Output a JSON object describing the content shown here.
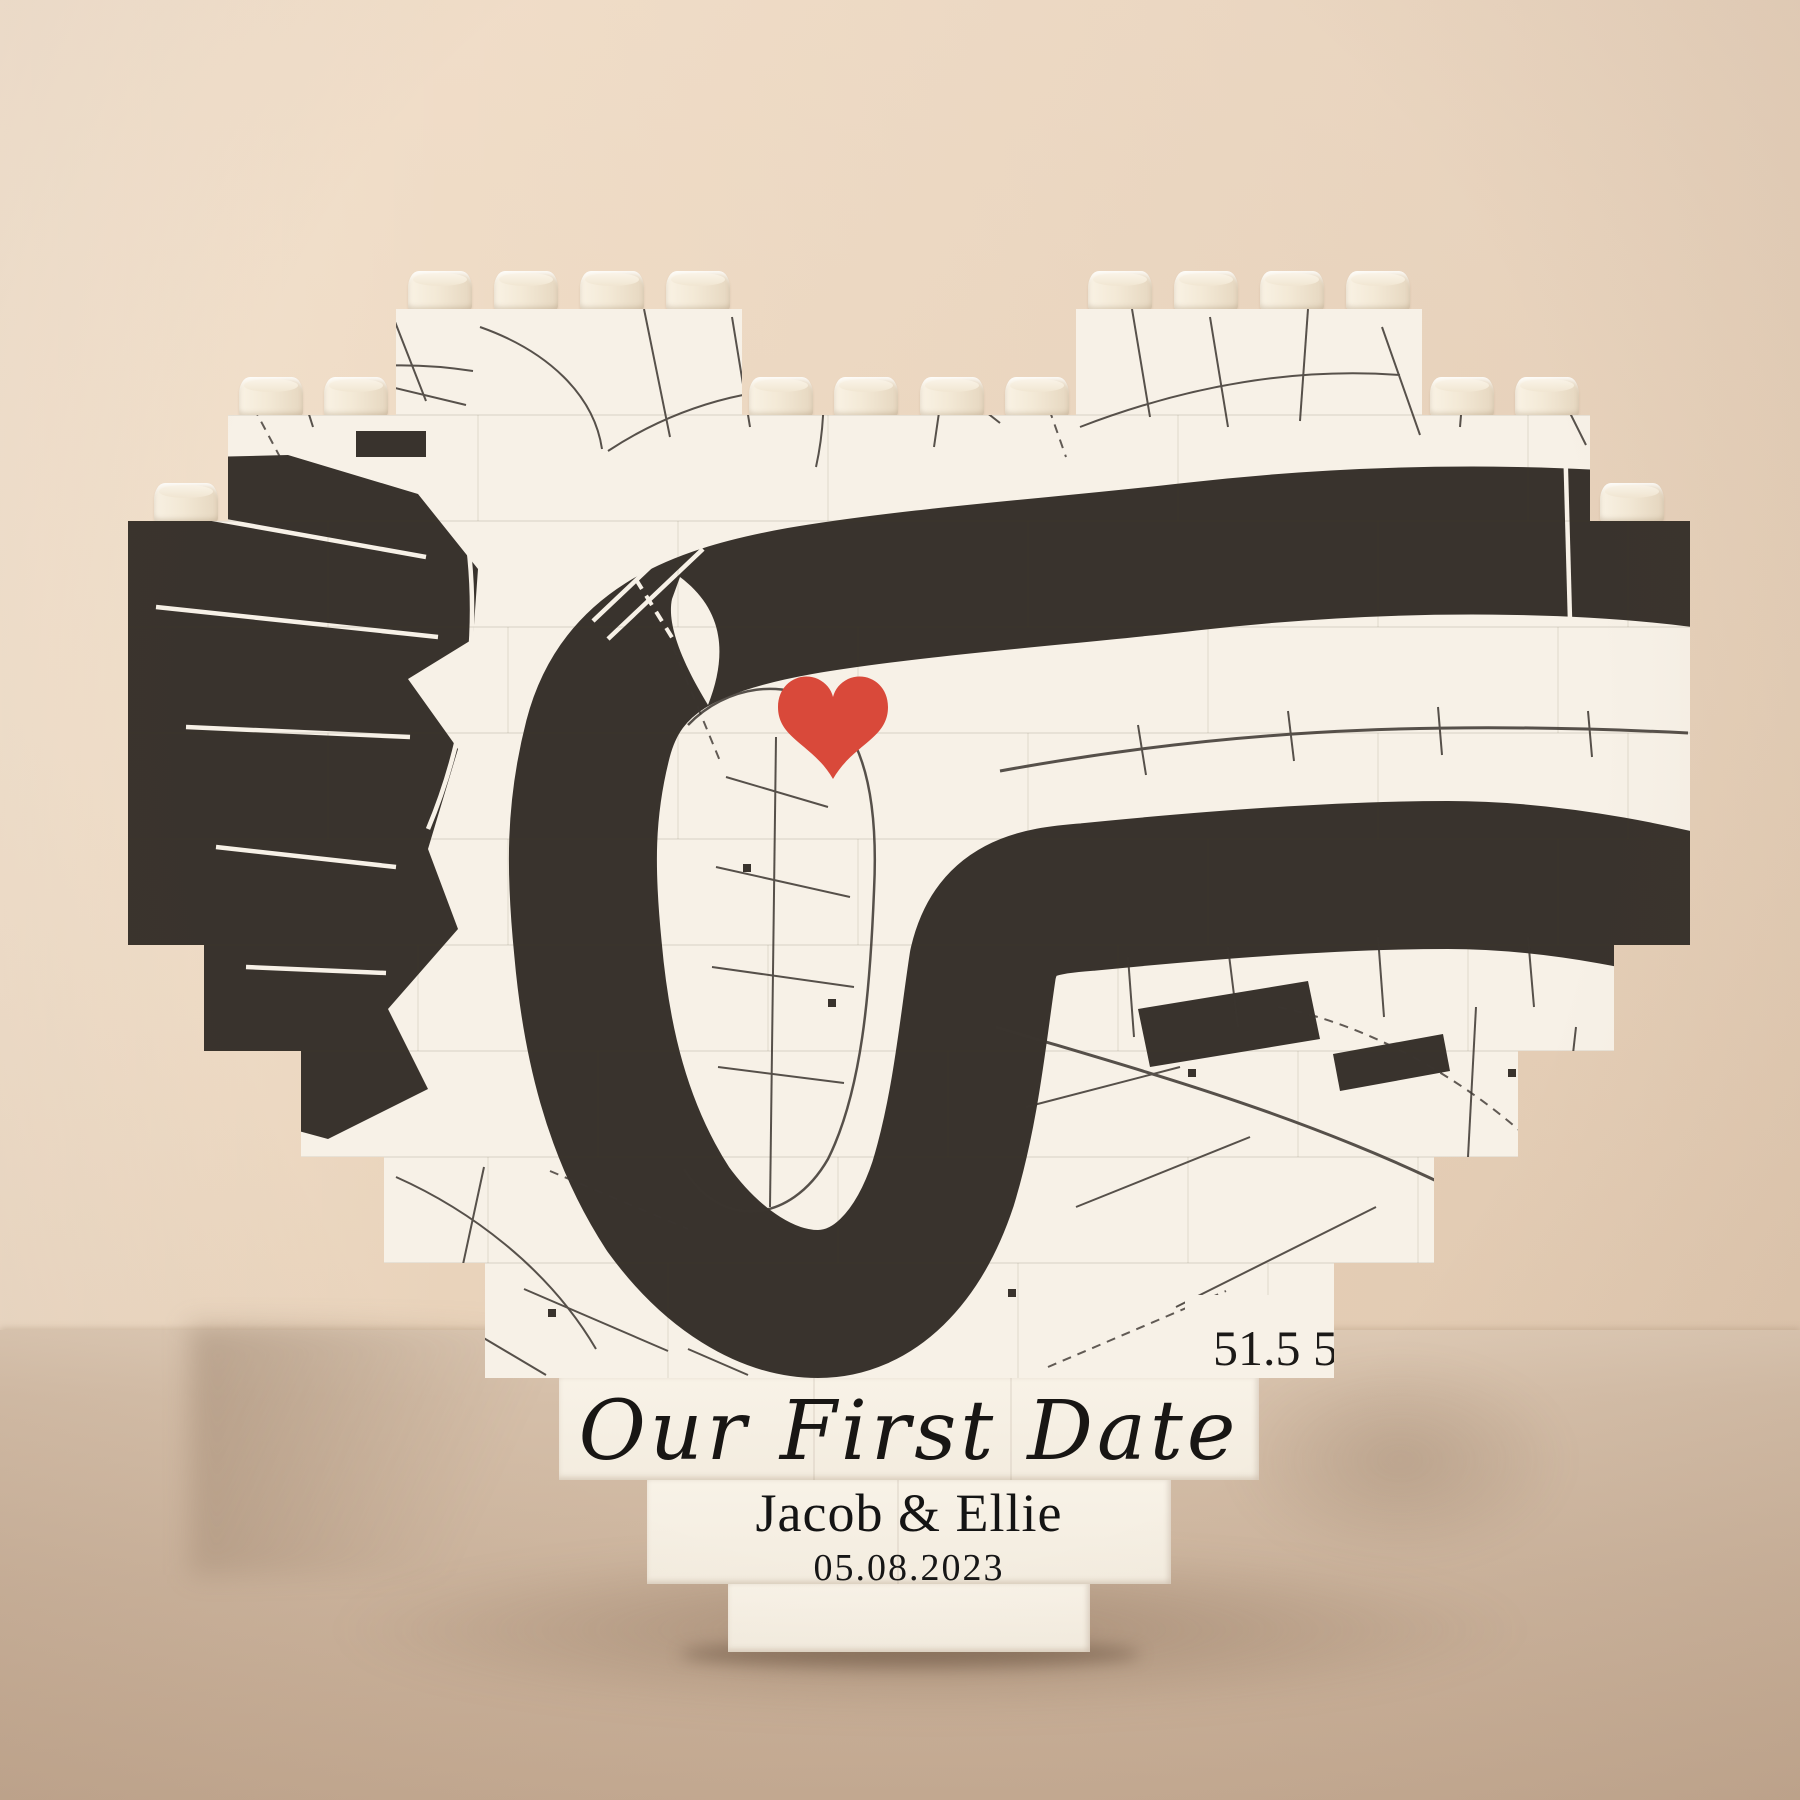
{
  "scene": {
    "wall_color": "#ecd8c1",
    "table_color": "#d2bca6"
  },
  "puzzle": {
    "brick_color": "#f5eee2",
    "title": "Our First Date",
    "names": "Jacob & Ellie",
    "date": "05.08.2023",
    "map": {
      "land_color": "#f7f1e7",
      "river_color": "#39332d",
      "marker_color": "#d9493a",
      "coordinate_label": "51.5 5"
    }
  }
}
